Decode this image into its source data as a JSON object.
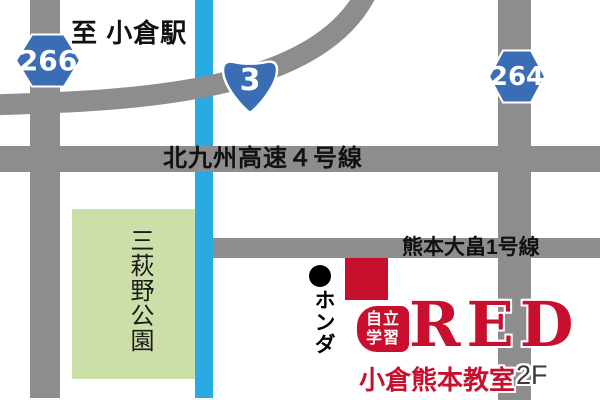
{
  "map": {
    "destination_label": "至 小倉駅",
    "shields": {
      "pref_266": "266",
      "national_3": "3",
      "pref_264": "264"
    },
    "roads": {
      "expressway": "北九州高速４号線",
      "kumamoto": "熊本大畠1号線"
    },
    "park": "三萩野公園",
    "honda": {
      "bullet": "●",
      "label": "ホンダ"
    },
    "logo": {
      "badge_top": "自立",
      "badge_bottom": "学習",
      "brand": "RED",
      "classroom": "小倉熊本教室",
      "floor": "2F"
    },
    "colors": {
      "road_gray": "#8d8d8d",
      "route_blue": "#29abe2",
      "shield_blue": "#3a6db4",
      "park_green": "#cddfa9",
      "brand_red": "#c8102e",
      "floor_gray": "#3d3a39"
    }
  }
}
